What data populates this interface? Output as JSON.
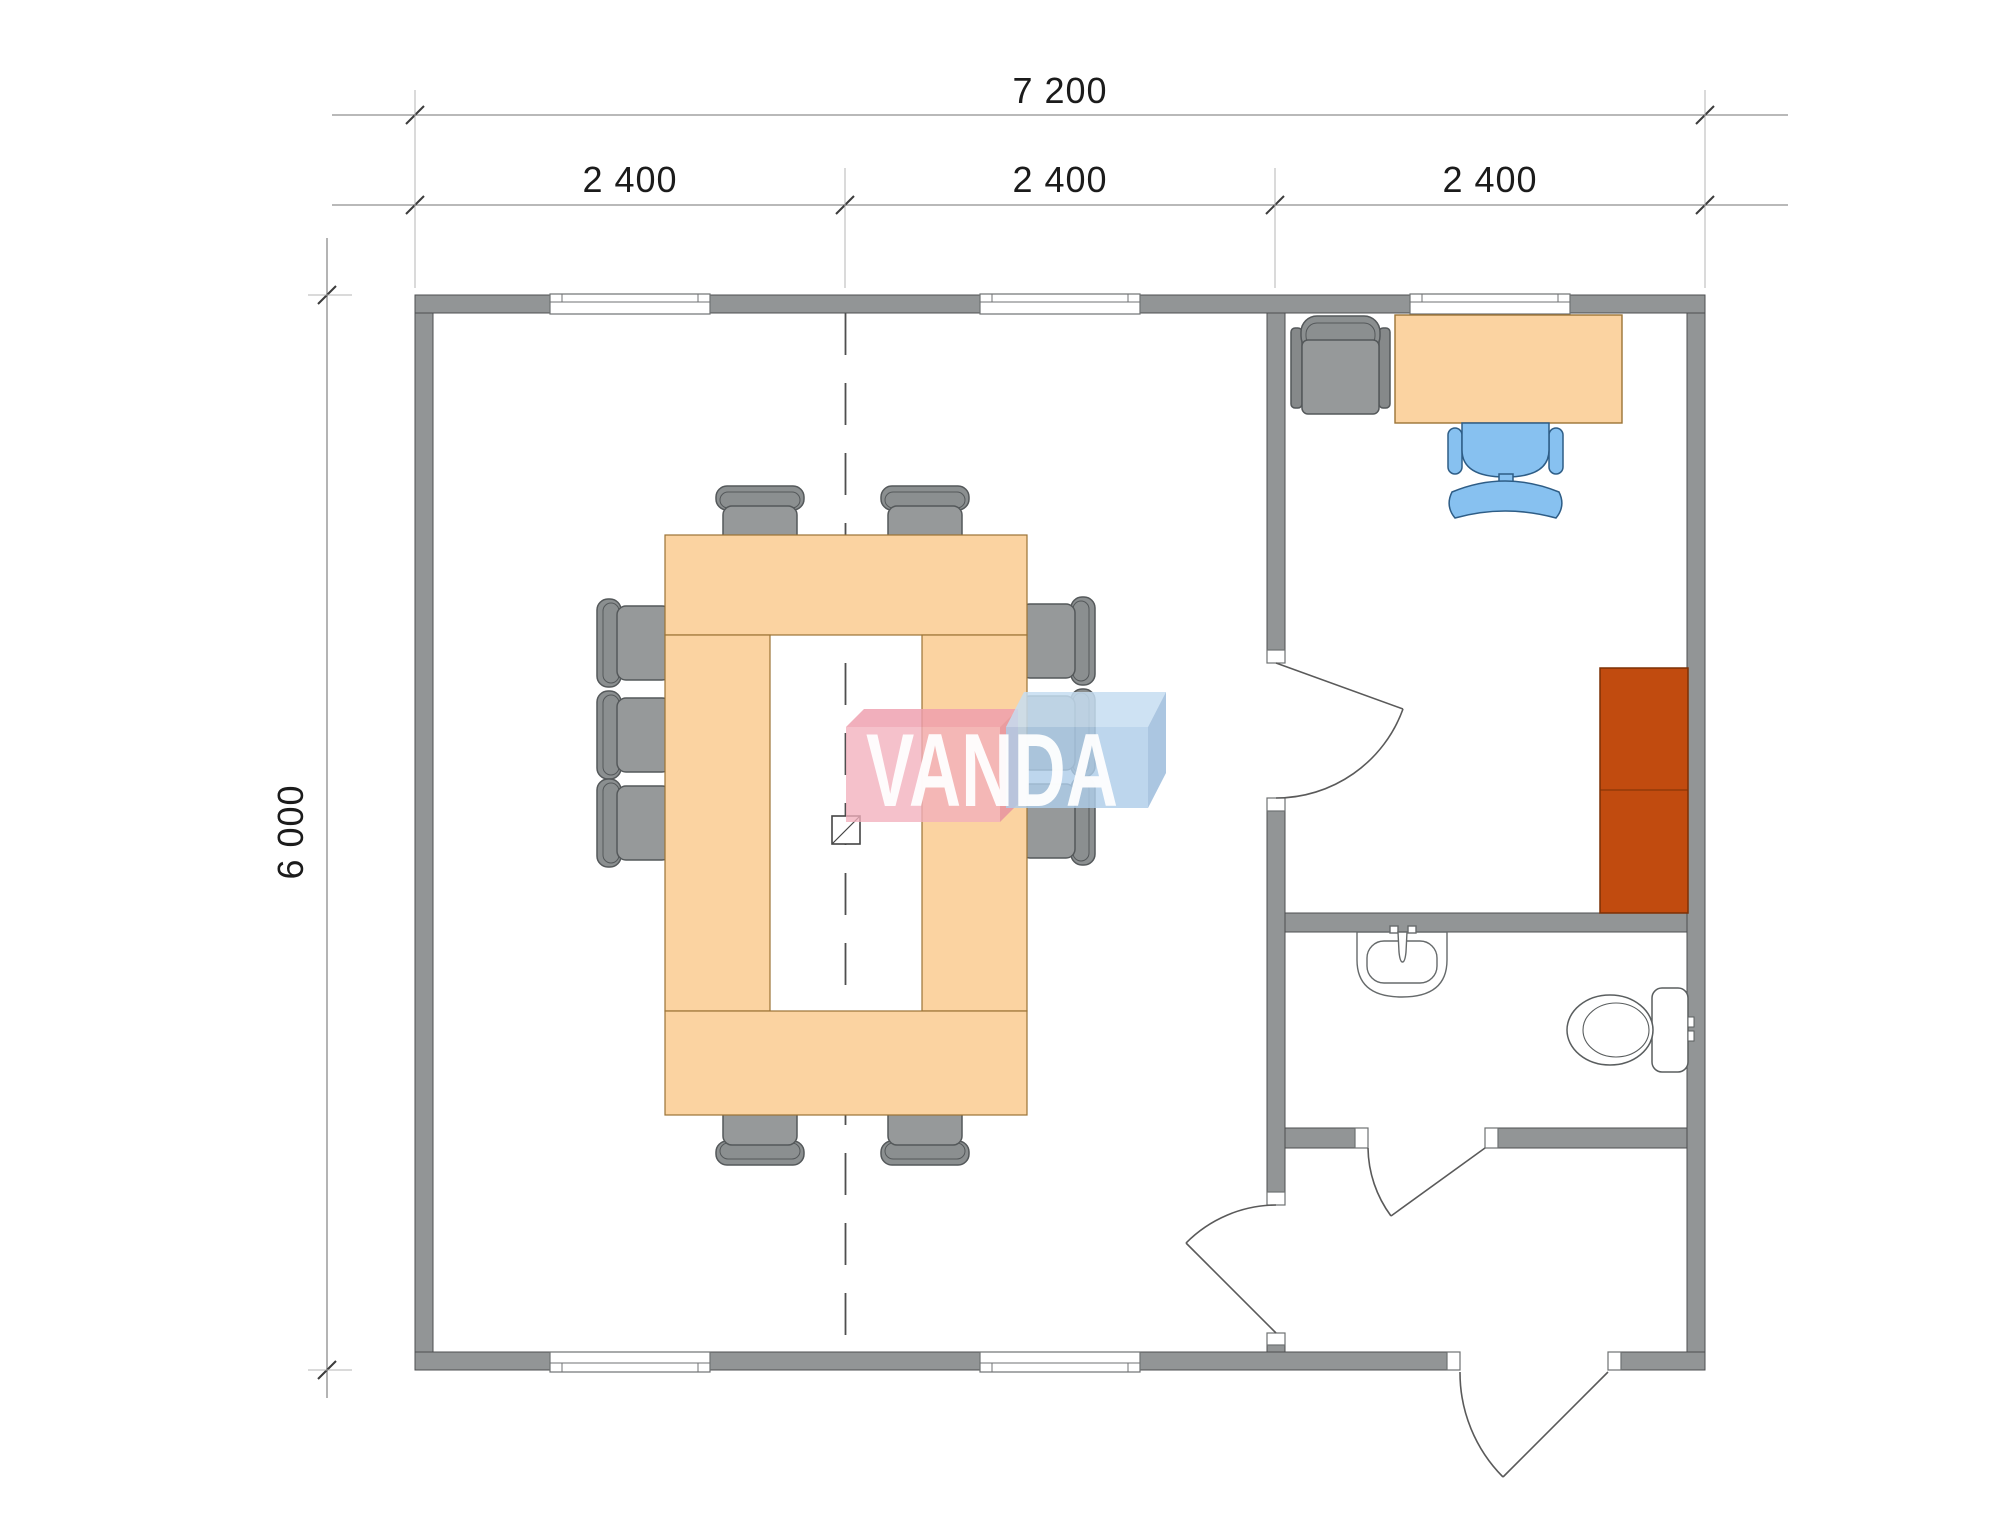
{
  "page": {
    "title": "Floor plan drawing",
    "background": "#ffffff"
  },
  "dimensions": {
    "width_total": "7 200",
    "width_modules": [
      "2 400",
      "2 400",
      "2 400"
    ],
    "height_total": "6 000"
  },
  "logo": {
    "text": "VANDA",
    "pink": "#F2AFBC",
    "blue": "#AFCDE9"
  },
  "plan": {
    "rooms": [
      "meeting-room",
      "office",
      "bathroom",
      "entry-hall"
    ],
    "furniture": {
      "meeting_room": {
        "conference_table": "U-shaped",
        "chairs": 10,
        "floor_box": 1
      },
      "office": {
        "desk": 1,
        "lounge_chair": 1,
        "desk_chair": 1,
        "cabinet": 1
      },
      "bathroom": {
        "sink": 1,
        "toilet": 1
      }
    },
    "windows": {
      "top_wall": 3,
      "bottom_wall": 2
    },
    "doors": {
      "interior": 3,
      "exterior": 1
    },
    "colors": {
      "walls": "#929596",
      "wood_furniture": "#FBD3A1",
      "meeting_chairs": "#96999A",
      "desk_chair_blue": "#87C1F0",
      "cabinet_rust": "#C14B0F",
      "dimension_text": "#1b1b1b"
    }
  }
}
